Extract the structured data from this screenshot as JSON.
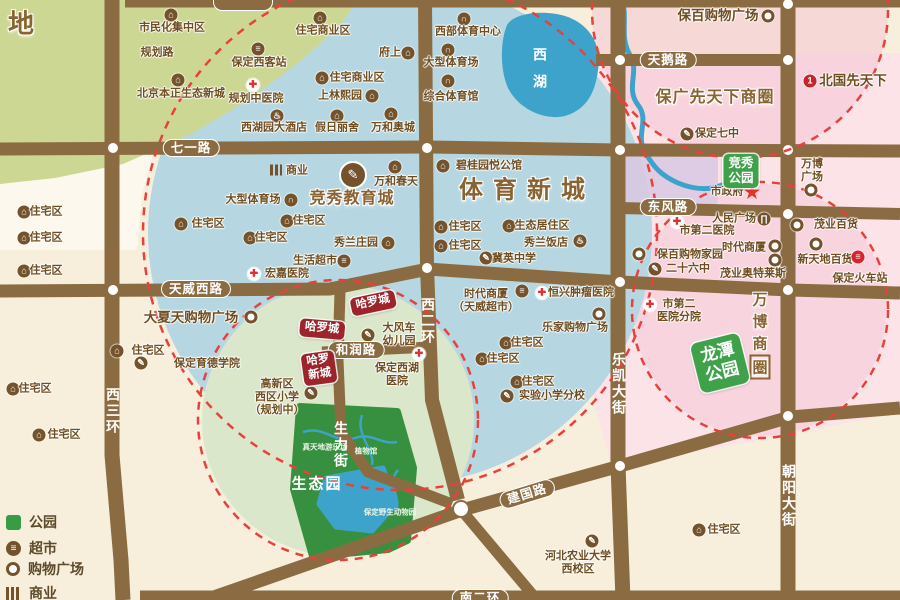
{
  "colors": {
    "bg": "#f7efdc",
    "road": "#8b6c42",
    "pink": "#fbe3e8",
    "pink_deep": "#f5c6d3",
    "blue_zone": "#b6d7e1",
    "lake": "#3ea3cb",
    "park_green": "#37903f",
    "zone_green": "#dbe7ca",
    "nw_green": "#ccd794",
    "dashed_red": "#e8413c",
    "badge_red": "#9e242c",
    "badge_green": "#3fa24a",
    "lavender": "#d9c9e3",
    "text_brown": "#6f4e21",
    "big_label_brown": "#8a6332"
  },
  "road_labels": [
    {
      "t": "七一路",
      "x": 191,
      "y": 148,
      "pill": 1
    },
    {
      "t": "天威西路",
      "x": 196,
      "y": 289,
      "pill": 1
    },
    {
      "t": "和润路",
      "x": 356,
      "y": 350,
      "pill": 1
    },
    {
      "t": "建国路",
      "x": 527,
      "y": 494,
      "pill": 1,
      "rot": -17
    },
    {
      "t": "南二环",
      "x": 480,
      "y": 598,
      "pill": 1
    },
    {
      "t": "天鹅路",
      "x": 668,
      "y": 60,
      "pill": 1
    },
    {
      "t": "东风路",
      "x": 668,
      "y": 207,
      "pill": 1
    },
    {
      "t": "西三环",
      "x": 113,
      "y": 411,
      "vert": 1
    },
    {
      "t": "西二环",
      "x": 428,
      "y": 321,
      "vert": 1
    },
    {
      "t": "生力街",
      "x": 341,
      "y": 445,
      "vert": 1
    },
    {
      "t": "乐凯大街",
      "x": 619,
      "y": 384,
      "vert": 1
    },
    {
      "t": "朝阳大街",
      "x": 789,
      "y": 496,
      "vert": 1
    }
  ],
  "area_labels": [
    {
      "t": "体育新城",
      "x": 527,
      "y": 187,
      "cls": "xxl"
    },
    {
      "t": "竞秀教育城",
      "x": 352,
      "y": 196,
      "cls": "xl"
    },
    {
      "t": "保广先天下商圈",
      "x": 715,
      "y": 95,
      "cls": "xl"
    },
    {
      "lines": [
        "万",
        "博",
        "商",
        "圈"
      ],
      "x": 760,
      "y": 334,
      "cls": "wb",
      "boxlast": 1
    },
    {
      "t": "生态园",
      "x": 317,
      "y": 483,
      "cls": "park-big"
    },
    {
      "lines": [
        "西",
        "湖"
      ],
      "x": 540,
      "y": 68,
      "cls": "lake"
    },
    {
      "t": "地",
      "x": 22,
      "y": 22,
      "cls": "corner"
    }
  ],
  "badges": [
    {
      "lines": [
        "哈罗城"
      ],
      "x": 373,
      "y": 303,
      "rot": -12,
      "cls": "red"
    },
    {
      "lines": [
        "哈罗城"
      ],
      "x": 322,
      "y": 329,
      "rot": 5,
      "cls": "red"
    },
    {
      "lines": [
        "哈罗",
        "新城"
      ],
      "x": 319,
      "y": 368,
      "rot": -8,
      "cls": "red"
    },
    {
      "lines": [
        "竞秀",
        "公园"
      ],
      "x": 741,
      "y": 171,
      "rot": 0,
      "cls": "green"
    },
    {
      "lines": [
        "龙潭",
        "公园"
      ],
      "x": 720,
      "y": 363,
      "rot": -14,
      "cls": "green big"
    }
  ],
  "park_labels": [
    {
      "t": "真天地游乐场",
      "x": 325,
      "y": 447
    },
    {
      "t": "植物馆",
      "x": 366,
      "y": 451
    },
    {
      "t": "保定野生动物园",
      "x": 390,
      "y": 512
    }
  ],
  "pois": [
    {
      "t": "住宅区",
      "x": 46,
      "y": 212,
      "ic": "home",
      "ix": 24,
      "iy": 212
    },
    {
      "t": "住宅区",
      "x": 46,
      "y": 238,
      "ic": "home",
      "ix": 24,
      "iy": 238
    },
    {
      "t": "住宅区",
      "x": 46,
      "y": 271,
      "ic": "home",
      "ix": 24,
      "iy": 271
    },
    {
      "t": "住宅区",
      "x": 148,
      "y": 351,
      "ic": "home",
      "ix": 117,
      "iy": 351
    },
    {
      "t": "住宅区",
      "x": 35,
      "y": 389,
      "ic": "home",
      "ix": 13,
      "iy": 389
    },
    {
      "t": "住宅区",
      "x": 64,
      "y": 435,
      "ic": "home",
      "ix": 39,
      "iy": 435
    },
    {
      "t": "市民化集中区",
      "x": 172,
      "y": 28,
      "ic": "home",
      "ix": 171,
      "iy": 15
    },
    {
      "t": "规划路",
      "x": 157,
      "y": 53
    },
    {
      "t": "北京本正生态新城",
      "x": 181,
      "y": 94,
      "ic": "home",
      "ix": 178,
      "iy": 80
    },
    {
      "t": "保定西客站",
      "x": 259,
      "y": 63,
      "ic": "station",
      "ix": 258,
      "iy": 49
    },
    {
      "t": "规划中医院",
      "x": 256,
      "y": 99,
      "ic": "hosp",
      "ix": 253,
      "iy": 85
    },
    {
      "t": "西湖园大酒店",
      "x": 274,
      "y": 128,
      "ic": "hotel",
      "ix": 277,
      "iy": 116
    },
    {
      "t": "住宅商业区",
      "x": 323,
      "y": 31,
      "ic": "home",
      "ix": 320,
      "iy": 18
    },
    {
      "t": "府上",
      "x": 390,
      "y": 53,
      "ic": "home",
      "ix": 408,
      "iy": 53
    },
    {
      "t": "住宅商业区",
      "x": 357,
      "y": 78,
      "ic": "home",
      "ix": 322,
      "iy": 78
    },
    {
      "t": "上林熙园",
      "x": 340,
      "y": 96,
      "ic": "home",
      "ix": 372,
      "iy": 96
    },
    {
      "t": "假日丽舍",
      "x": 337,
      "y": 128,
      "ic": "home",
      "ix": 337,
      "iy": 116
    },
    {
      "t": "万和奥城",
      "x": 393,
      "y": 128,
      "ic": "home",
      "ix": 391,
      "iy": 114
    },
    {
      "t": "西部体育中心",
      "x": 468,
      "y": 32,
      "ic": "stadium",
      "ix": 464,
      "iy": 19
    },
    {
      "t": "大型体育场",
      "x": 451,
      "y": 63,
      "ic": "stadium",
      "ix": 448,
      "iy": 50
    },
    {
      "t": "综合体育馆",
      "x": 451,
      "y": 97,
      "ic": "stadium",
      "ix": 448,
      "iy": 81
    },
    {
      "t": "商业",
      "x": 297,
      "y": 171,
      "ic": "biz",
      "ix": 276,
      "iy": 170
    },
    {
      "t": "大型体育场",
      "x": 253,
      "y": 200,
      "ic": "stadium",
      "ix": 291,
      "iy": 200
    },
    {
      "t": "住宅区",
      "x": 208,
      "y": 224,
      "ic": "home",
      "ix": 181,
      "iy": 224
    },
    {
      "t": "住宅区",
      "x": 309,
      "y": 221,
      "ic": "home",
      "ix": 287,
      "iy": 221
    },
    {
      "t": "住宅区",
      "x": 271,
      "y": 238,
      "ic": "home",
      "ix": 250,
      "iy": 238
    },
    {
      "t": "碧桂园悦公馆",
      "x": 489,
      "y": 166,
      "ic": "home",
      "ix": 443,
      "iy": 166
    },
    {
      "t": "万和春天",
      "x": 396,
      "y": 182,
      "ic": "home",
      "ix": 395,
      "iy": 167
    },
    {
      "t": "住宅区",
      "x": 465,
      "y": 227,
      "ic": "home",
      "ix": 441,
      "iy": 227
    },
    {
      "t": "住宅区",
      "x": 465,
      "y": 246,
      "ic": "home",
      "ix": 441,
      "iy": 246
    },
    {
      "t": "生态居住区",
      "x": 542,
      "y": 226,
      "ic": "home",
      "ix": 509,
      "iy": 226
    },
    {
      "t": "秀兰庄园",
      "x": 356,
      "y": 243,
      "ic": "home",
      "ix": 388,
      "iy": 243
    },
    {
      "t": "秀兰饭店",
      "x": 546,
      "y": 243,
      "ic": "hotel",
      "ix": 580,
      "iy": 241
    },
    {
      "t": "冀英中学",
      "x": 514,
      "y": 259,
      "ic": "school",
      "ix": 486,
      "iy": 258
    },
    {
      "t": "生活超市",
      "x": 315,
      "y": 261,
      "ic": "super",
      "ix": 344,
      "iy": 261
    },
    {
      "t": "宏嘉医院",
      "x": 287,
      "y": 274,
      "ic": "hosp",
      "ix": 254,
      "iy": 274
    },
    {
      "lines": [
        "时代商厦",
        "（天威超市）"
      ],
      "x": 486,
      "y": 301,
      "ic": "super",
      "ix": 522,
      "iy": 291
    },
    {
      "t": "恒兴肿瘤医院",
      "x": 581,
      "y": 293,
      "ic": "hosp",
      "ix": 542,
      "iy": 293
    },
    {
      "t": "乐家购物广场",
      "x": 575,
      "y": 328,
      "ic": "shop",
      "ix": 599,
      "iy": 314
    },
    {
      "t": "住宅区",
      "x": 527,
      "y": 343,
      "ic": "home",
      "ix": 506,
      "iy": 343
    },
    {
      "t": "住宅区",
      "x": 503,
      "y": 359,
      "ic": "home",
      "ix": 482,
      "iy": 359
    },
    {
      "t": "住宅区",
      "x": 538,
      "y": 382,
      "ic": "home",
      "ix": 517,
      "iy": 382
    },
    {
      "t": "实验小学分校",
      "x": 552,
      "y": 396,
      "ic": "school",
      "ix": 507,
      "iy": 396
    },
    {
      "lines": [
        "保定西湖",
        "医院"
      ],
      "x": 397,
      "y": 375,
      "ic": "hosp",
      "ix": 419,
      "iy": 354
    },
    {
      "lines": [
        "大风车",
        "幼儿园"
      ],
      "x": 399,
      "y": 335,
      "ic": "school",
      "ix": 368,
      "iy": 335
    },
    {
      "lines": [
        "高新区",
        "西区小学",
        "（规划中）"
      ],
      "x": 277,
      "y": 398,
      "ic": "school",
      "ix": 311,
      "iy": 393
    },
    {
      "t": "保定育德学院",
      "x": 207,
      "y": 364,
      "ic": "school",
      "ix": 141,
      "iy": 363
    },
    {
      "t": "大夏天购物广场",
      "x": 191,
      "y": 318,
      "ic": "shop",
      "ix": 251,
      "iy": 317,
      "cls": "big"
    },
    {
      "t": "保百购物广场",
      "x": 718,
      "y": 16,
      "ic": "shop",
      "ix": 768,
      "iy": 16,
      "cls": "big"
    },
    {
      "t": "北国先天下",
      "x": 853,
      "y": 81,
      "ic": "one",
      "ix": 810,
      "iy": 81,
      "cls": "big"
    },
    {
      "t": "保定七中",
      "x": 717,
      "y": 134,
      "ic": "school",
      "ix": 687,
      "iy": 134
    },
    {
      "t": "市政府",
      "x": 727,
      "y": 192,
      "ic": "star",
      "ix": 752,
      "iy": 192
    },
    {
      "lines": [
        "万博",
        "广场"
      ],
      "x": 812,
      "y": 171,
      "ic": "shop",
      "ix": 811,
      "iy": 190
    },
    {
      "t": "人民广场",
      "x": 734,
      "y": 219,
      "ic": "gov",
      "ix": 764,
      "iy": 219
    },
    {
      "t": "市第二医院",
      "x": 707,
      "y": 231,
      "ic": "hosp",
      "ix": 677,
      "iy": 222
    },
    {
      "t": "保百购物家园",
      "x": 690,
      "y": 255,
      "ic": "shop",
      "ix": 639,
      "iy": 254
    },
    {
      "t": "二十六中",
      "x": 688,
      "y": 269,
      "ic": "school",
      "ix": 655,
      "iy": 269
    },
    {
      "t": "时代商厦",
      "x": 744,
      "y": 248,
      "ic": "shop",
      "ix": 775,
      "iy": 246
    },
    {
      "t": "茂业奥特莱斯",
      "x": 753,
      "y": 274,
      "ic": "shop",
      "ix": 775,
      "iy": 260
    },
    {
      "t": "茂业百货",
      "x": 836,
      "y": 225,
      "ic": "shop",
      "ix": 797,
      "iy": 225
    },
    {
      "t": "新天地百货",
      "x": 825,
      "y": 260,
      "ic": "shop",
      "ix": 816,
      "iy": 244
    },
    {
      "t": "保定火车站",
      "x": 860,
      "y": 279,
      "ic": "train",
      "ix": 858,
      "iy": 257
    },
    {
      "lines": [
        "市第二",
        "医院分院"
      ],
      "x": 679,
      "y": 311,
      "ic": "hosp",
      "ix": 650,
      "iy": 305
    },
    {
      "t": "住宅区",
      "x": 724,
      "y": 530,
      "ic": "home",
      "ix": 699,
      "iy": 530
    },
    {
      "lines": [
        "河北农业大学",
        "西校区"
      ],
      "x": 578,
      "y": 563,
      "ic": "school",
      "ix": 592,
      "iy": 541
    }
  ],
  "legend": {
    "items": [
      {
        "icon": "park",
        "label": "公园",
        "y": 521
      },
      {
        "icon": "super",
        "label": "超市",
        "y": 547
      },
      {
        "icon": "shop",
        "label": "购物广场",
        "y": 568
      },
      {
        "icon": "biz",
        "label": "商业",
        "y": 592
      }
    ]
  }
}
